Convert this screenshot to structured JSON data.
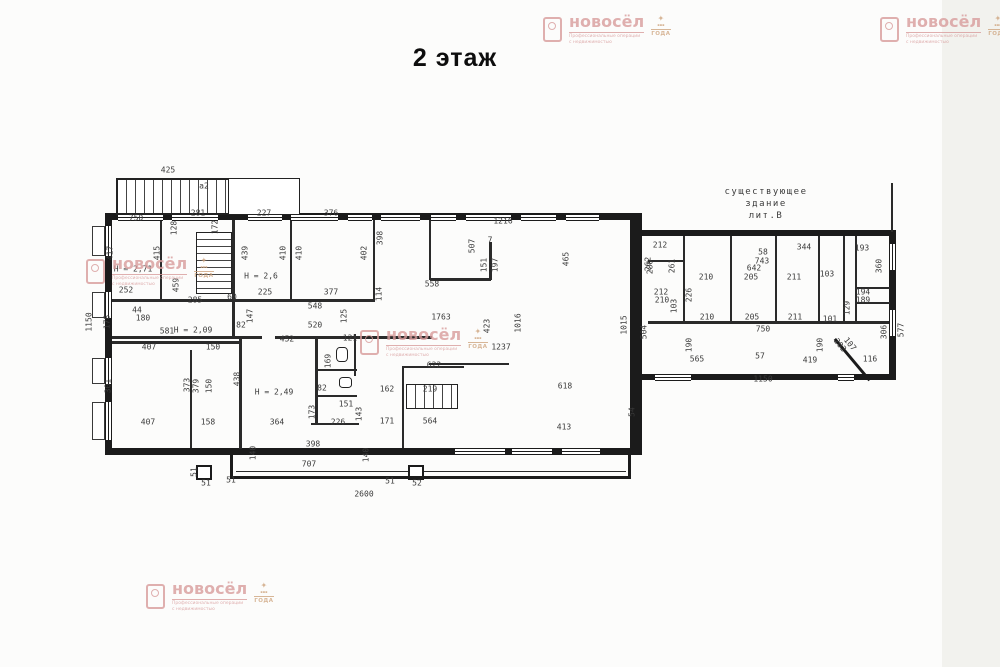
{
  "title": "2 этаж",
  "annotation": {
    "line1": "существующее",
    "line2": "здание",
    "line3": "лит.В"
  },
  "watermark": {
    "name": "новосёл",
    "tagline1": "Профессиональные операции",
    "tagline2": "с недвижимостью",
    "award": "ГОДА",
    "color": "#d89c9c",
    "emblem_color": "#cfa57f",
    "positions": [
      [
        543,
        14
      ],
      [
        880,
        14
      ],
      [
        86,
        256
      ],
      [
        360,
        327
      ],
      [
        146,
        581
      ]
    ]
  },
  "plan": {
    "wall_color": "#1b1b1b",
    "walls": [
      [
        105,
        213,
        537,
        7
      ],
      [
        105,
        213,
        7,
        242
      ],
      [
        105,
        448,
        537,
        7
      ],
      [
        630,
        213,
        12,
        242
      ],
      [
        640,
        230,
        256,
        6
      ],
      [
        889,
        230,
        7,
        150
      ],
      [
        640,
        374,
        256,
        6
      ]
    ],
    "thin_walls": [
      [
        160,
        220,
        2,
        80
      ],
      [
        232,
        220,
        3,
        116
      ],
      [
        290,
        220,
        2,
        80
      ],
      [
        373,
        220,
        2,
        80
      ],
      [
        112,
        299,
        263,
        3
      ],
      [
        112,
        336,
        150,
        3
      ],
      [
        275,
        336,
        157,
        3
      ],
      [
        429,
        220,
        2,
        60
      ],
      [
        489,
        242,
        3,
        38
      ],
      [
        430,
        278,
        61,
        3
      ],
      [
        239,
        339,
        3,
        110
      ],
      [
        190,
        350,
        2,
        98
      ],
      [
        112,
        341,
        127,
        3
      ],
      [
        315,
        337,
        3,
        88
      ],
      [
        354,
        334,
        2,
        42
      ],
      [
        315,
        369,
        42,
        2
      ],
      [
        315,
        395,
        42,
        2
      ],
      [
        311,
        423,
        48,
        2
      ],
      [
        402,
        366,
        2,
        82
      ],
      [
        402,
        366,
        62,
        2
      ],
      [
        429,
        363,
        80,
        2
      ],
      [
        648,
        321,
        243,
        3
      ],
      [
        683,
        236,
        2,
        87
      ],
      [
        730,
        236,
        2,
        87
      ],
      [
        775,
        236,
        2,
        87
      ],
      [
        818,
        236,
        2,
        87
      ],
      [
        843,
        236,
        2,
        87
      ],
      [
        855,
        236,
        2,
        86
      ],
      [
        855,
        287,
        35,
        2
      ],
      [
        855,
        302,
        35,
        2
      ],
      [
        648,
        260,
        35,
        2
      ],
      [
        891,
        183,
        2,
        49
      ],
      [
        236,
        471,
        390,
        1
      ]
    ],
    "windows_h": [
      [
        118,
        214,
        45
      ],
      [
        172,
        214,
        46
      ],
      [
        248,
        214,
        34
      ],
      [
        291,
        214,
        47
      ],
      [
        348,
        214,
        24
      ],
      [
        381,
        214,
        39
      ],
      [
        431,
        214,
        25
      ],
      [
        466,
        214,
        45
      ],
      [
        521,
        214,
        35
      ],
      [
        566,
        214,
        33
      ],
      [
        455,
        448,
        50
      ],
      [
        512,
        448,
        40
      ],
      [
        562,
        448,
        38
      ],
      [
        655,
        374,
        36
      ],
      [
        838,
        374,
        16
      ]
    ],
    "windows_v": [
      [
        105,
        226,
        30
      ],
      [
        105,
        292,
        26
      ],
      [
        105,
        358,
        26
      ],
      [
        105,
        402,
        38
      ],
      [
        889,
        244,
        26
      ],
      [
        889,
        310,
        26
      ]
    ],
    "sills": [
      [
        92,
        226,
        13,
        30
      ],
      [
        92,
        292,
        13,
        26
      ],
      [
        92,
        358,
        13,
        26
      ],
      [
        92,
        402,
        13,
        38
      ]
    ],
    "pillars": [
      [
        196,
        465,
        16,
        15
      ],
      [
        408,
        465,
        16,
        15
      ]
    ],
    "frames": [
      [
        116,
        178,
        184,
        37
      ]
    ],
    "stairs": [
      {
        "x": 117,
        "y": 179,
        "w": 112,
        "h": 35,
        "dir": "v"
      },
      {
        "x": 196,
        "y": 232,
        "w": 36,
        "h": 62,
        "dir": "h"
      },
      {
        "x": 406,
        "y": 384,
        "w": 52,
        "h": 25,
        "dir": "v"
      }
    ],
    "balcony": {
      "x": 230,
      "y": 452,
      "w": 401,
      "h": 27
    },
    "diagonals": [
      {
        "x": 836,
        "y": 338,
        "len": 54,
        "deg": 50
      }
    ],
    "fixtures": [
      [
        336,
        347,
        12,
        15
      ],
      [
        339,
        377,
        13,
        11
      ]
    ],
    "labels": [
      [
        "425",
        168,
        170,
        0
      ],
      [
        "а2",
        204,
        186,
        0
      ],
      [
        "750",
        136,
        218,
        0
      ],
      [
        "281",
        198,
        213,
        0
      ],
      [
        "128",
        174,
        228,
        -90
      ],
      [
        "172",
        215,
        227,
        -90
      ],
      [
        "227",
        264,
        213,
        0
      ],
      [
        "376",
        331,
        213,
        0
      ],
      [
        "1216",
        503,
        221,
        0
      ],
      [
        "417",
        110,
        253,
        -90
      ],
      [
        "415",
        157,
        253,
        -90
      ],
      [
        "439",
        245,
        253,
        -90
      ],
      [
        "410",
        283,
        253,
        -90
      ],
      [
        "410",
        299,
        253,
        -90
      ],
      [
        "402",
        364,
        253,
        -90
      ],
      [
        "398",
        380,
        238,
        -90
      ],
      [
        "507",
        472,
        246,
        -90
      ],
      [
        "7",
        490,
        240,
        0
      ],
      [
        "151",
        484,
        265,
        -90
      ],
      [
        "197",
        495,
        265,
        -90
      ],
      [
        "465",
        566,
        259,
        -90
      ],
      [
        "558",
        432,
        284,
        0
      ],
      [
        "Н = 2,71",
        133,
        269,
        0
      ],
      [
        "252",
        126,
        290,
        0
      ],
      [
        "Н = 2,6",
        261,
        276,
        0
      ],
      [
        "225",
        265,
        292,
        0
      ],
      [
        "377",
        331,
        292,
        0
      ],
      [
        "285",
        195,
        300,
        0
      ],
      [
        "459",
        176,
        285,
        -90
      ],
      [
        "44",
        137,
        310,
        0
      ],
      [
        "180",
        143,
        318,
        0
      ],
      [
        "178",
        107,
        322,
        -90
      ],
      [
        "1150",
        89,
        322,
        -90
      ],
      [
        "581",
        167,
        331,
        0
      ],
      [
        "Н = 2,09",
        193,
        330,
        0
      ],
      [
        "548",
        315,
        306,
        0
      ],
      [
        "520",
        315,
        325,
        0
      ],
      [
        "82",
        241,
        325,
        0
      ],
      [
        "147",
        250,
        316,
        -90
      ],
      [
        "114",
        379,
        294,
        -90
      ],
      [
        "125",
        344,
        316,
        -90
      ],
      [
        "60",
        232,
        297,
        0
      ],
      [
        "1763",
        441,
        317,
        0
      ],
      [
        "423",
        487,
        326,
        -90
      ],
      [
        "1016",
        518,
        323,
        -90
      ],
      [
        "1237",
        501,
        347,
        0
      ],
      [
        "1015",
        624,
        325,
        -90
      ],
      [
        "504",
        644,
        332,
        -90
      ],
      [
        "280",
        650,
        267,
        -90
      ],
      [
        "407",
        149,
        347,
        0
      ],
      [
        "150",
        213,
        347,
        0
      ],
      [
        "301",
        108,
        386,
        -90
      ],
      [
        "373",
        187,
        385,
        -90
      ],
      [
        "379",
        196,
        386,
        -90
      ],
      [
        "150",
        209,
        386,
        -90
      ],
      [
        "407",
        148,
        422,
        0
      ],
      [
        "158",
        208,
        422,
        0
      ],
      [
        "438",
        237,
        379,
        -90
      ],
      [
        "452",
        287,
        339,
        0
      ],
      [
        "121",
        350,
        338,
        0
      ],
      [
        "Н = 2,49",
        274,
        392,
        0
      ],
      [
        "169",
        328,
        361,
        -90
      ],
      [
        "82",
        322,
        388,
        0
      ],
      [
        "151",
        346,
        404,
        0
      ],
      [
        "173",
        312,
        412,
        -90
      ],
      [
        "143",
        359,
        414,
        -90
      ],
      [
        "226",
        338,
        422,
        0
      ],
      [
        "364",
        277,
        422,
        0
      ],
      [
        "171",
        387,
        421,
        0
      ],
      [
        "564",
        430,
        421,
        0
      ],
      [
        "622",
        434,
        365,
        0
      ],
      [
        "162",
        387,
        389,
        0
      ],
      [
        "219",
        430,
        389,
        0
      ],
      [
        "618",
        565,
        386,
        0
      ],
      [
        "413",
        564,
        427,
        0
      ],
      [
        "54",
        632,
        412,
        -90
      ],
      [
        "398",
        313,
        444,
        0
      ],
      [
        "140",
        253,
        453,
        -90
      ],
      [
        "140",
        366,
        455,
        -90
      ],
      [
        "707",
        309,
        464,
        0
      ],
      [
        "2600",
        364,
        494,
        0
      ],
      [
        "51",
        206,
        483,
        0
      ],
      [
        "51",
        194,
        472,
        -90
      ],
      [
        "51",
        231,
        480,
        0
      ],
      [
        "51",
        390,
        481,
        0
      ],
      [
        "52",
        417,
        483,
        0
      ],
      [
        "212",
        660,
        245,
        0
      ],
      [
        "58",
        763,
        252,
        0
      ],
      [
        "344",
        804,
        247,
        0
      ],
      [
        "193",
        862,
        248,
        0
      ],
      [
        "743",
        762,
        261,
        0
      ],
      [
        "642",
        754,
        268,
        0
      ],
      [
        "210",
        706,
        277,
        0
      ],
      [
        "205",
        751,
        277,
        0
      ],
      [
        "211",
        794,
        277,
        0
      ],
      [
        "103",
        827,
        274,
        0
      ],
      [
        "262",
        648,
        264,
        -90
      ],
      [
        "261",
        672,
        266,
        -90
      ],
      [
        "212",
        661,
        292,
        0
      ],
      [
        "210",
        662,
        300,
        0
      ],
      [
        "103",
        674,
        306,
        -90
      ],
      [
        "226",
        689,
        295,
        -90
      ],
      [
        "210",
        707,
        317,
        0
      ],
      [
        "205",
        752,
        317,
        0
      ],
      [
        "211",
        795,
        317,
        0
      ],
      [
        "101",
        830,
        319,
        0
      ],
      [
        "129",
        847,
        308,
        -90
      ],
      [
        "750",
        763,
        329,
        0
      ],
      [
        "190",
        689,
        345,
        -90
      ],
      [
        "190",
        820,
        345,
        -90
      ],
      [
        "565",
        697,
        359,
        0
      ],
      [
        "57",
        760,
        356,
        0
      ],
      [
        "419",
        810,
        360,
        0
      ],
      [
        "116",
        870,
        359,
        0
      ],
      [
        "1150",
        763,
        379,
        0
      ],
      [
        "194",
        863,
        292,
        0
      ],
      [
        "189",
        863,
        300,
        0
      ],
      [
        "360",
        879,
        266,
        -90
      ],
      [
        "306",
        884,
        332,
        -90
      ],
      [
        "577",
        901,
        330,
        -90
      ],
      [
        "202",
        840,
        345,
        51
      ],
      [
        "107",
        850,
        344,
        51
      ]
    ]
  }
}
